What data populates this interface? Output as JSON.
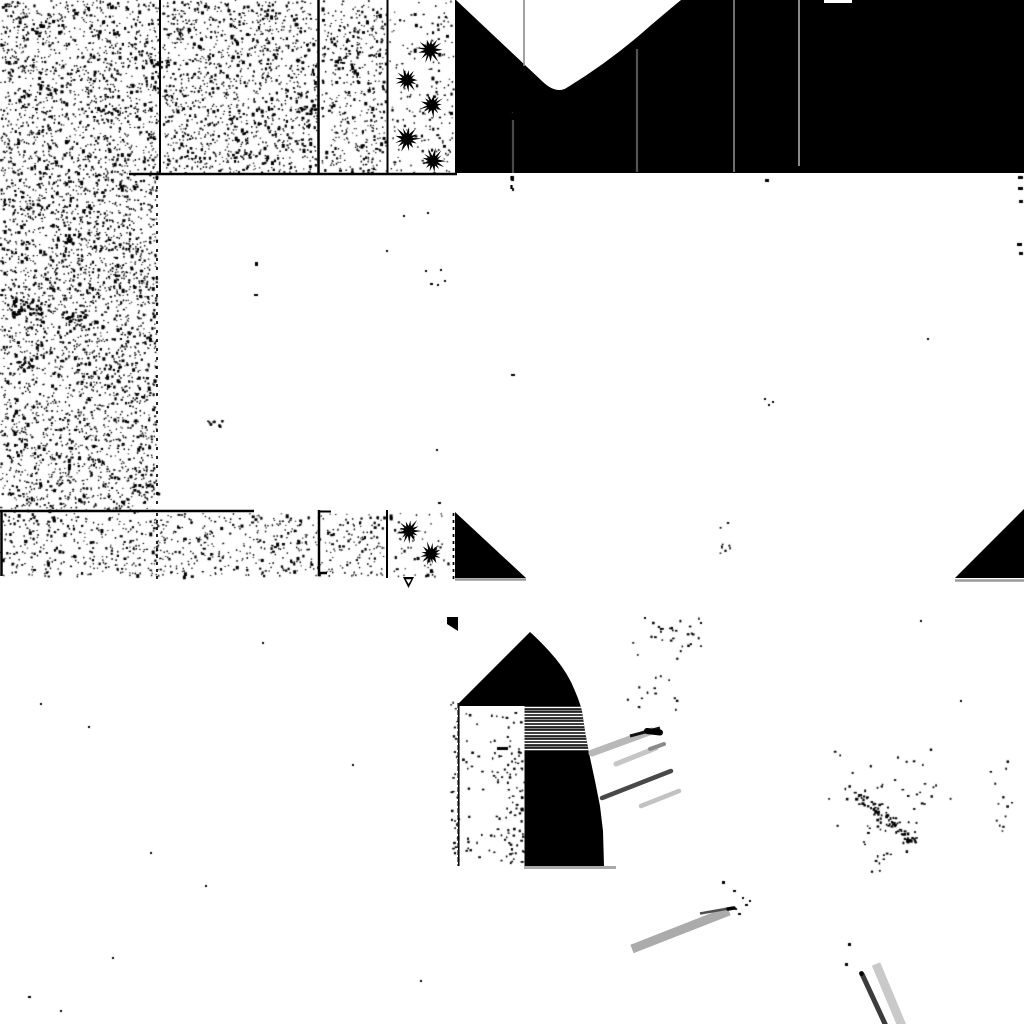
{
  "scene": {
    "width": 1024,
    "height": 1024,
    "background": "#ffffff",
    "ink": "#000000"
  },
  "palette": {
    "black": "#000000",
    "white": "#ffffff",
    "gray_dark": "#3c3c3c",
    "gray_mid": "#6f6f6f",
    "gray_light": "#b8b8b8",
    "gray_pale": "#c9c9c9",
    "underline_gray": "#9a9a9a"
  },
  "sky_region": {
    "x": 455,
    "y": 0,
    "w": 569,
    "h": 173,
    "color": "#000000"
  },
  "bite_path": "M456,0 L543,82 Q557,95 568,87 Q612,60 650,26 Q670,9 681,0 Z",
  "notch": {
    "x": 824,
    "y": 0,
    "w": 28,
    "h": 3
  },
  "pole_lines": [
    {
      "name": "pole-line-1",
      "x": 513,
      "y1": 112,
      "y2": 173,
      "color": "#4a4a4a",
      "w": 2.2
    },
    {
      "name": "pole-line-2",
      "x": 524,
      "y1": 0,
      "y2": 66,
      "color": "#8a8a8a",
      "w": 1.6
    },
    {
      "name": "pole-line-3",
      "x": 637,
      "y1": 49,
      "y2": 172,
      "color": "#555555",
      "w": 2.2
    },
    {
      "name": "pole-line-4",
      "x": 734,
      "y1": 0,
      "y2": 172,
      "color": "#6f6f6f",
      "w": 2.0
    },
    {
      "name": "pole-line-5",
      "x": 799,
      "y1": 0,
      "y2": 166,
      "color": "#8a8a8a",
      "w": 2.0
    }
  ],
  "grid_lines": [
    {
      "name": "tile-separator-1",
      "x1": 160,
      "y1": 0,
      "x2": 160,
      "y2": 173,
      "w": 2
    },
    {
      "name": "tile-separator-2",
      "x1": 318.5,
      "y1": 0,
      "x2": 318.5,
      "y2": 174,
      "w": 2.5
    },
    {
      "name": "tile-separator-3",
      "x1": 387.5,
      "y1": 0,
      "x2": 387.5,
      "y2": 173,
      "w": 2
    },
    {
      "name": "band-bottom-line",
      "x1": 129,
      "y1": 174,
      "x2": 457,
      "y2": 174,
      "w": 2.5
    },
    {
      "name": "band2-top-line",
      "x1": 0,
      "y1": 511,
      "x2": 254,
      "y2": 511,
      "w": 2.5
    },
    {
      "name": "band2-left-tick",
      "x1": 1.5,
      "y1": 511,
      "x2": 1.5,
      "y2": 576,
      "w": 2.5
    },
    {
      "name": "band2-separator-1",
      "x1": 319,
      "y1": 510,
      "x2": 319,
      "y2": 576,
      "w": 2.5
    },
    {
      "name": "band2-sep1-tick-a",
      "x1": 318,
      "y1": 511.5,
      "x2": 331,
      "y2": 511.5,
      "w": 2
    },
    {
      "name": "band2-sep1-tick-b",
      "x1": 318,
      "y1": 573,
      "x2": 327,
      "y2": 573,
      "w": 2.5
    },
    {
      "name": "band2-separator-2",
      "x1": 387,
      "y1": 510,
      "x2": 387,
      "y2": 578,
      "w": 2
    }
  ],
  "dashed_lines": [
    {
      "name": "dashed-edge-upper",
      "x1": 157,
      "y1": 177,
      "x2": 157,
      "y2": 509,
      "w": 1.7,
      "dash": "3 6"
    },
    {
      "name": "dashed-edge-band2",
      "x1": 157,
      "y1": 513,
      "x2": 157,
      "y2": 580,
      "w": 1.7,
      "dash": "3 4"
    },
    {
      "name": "dashed-edge-wedge",
      "x1": 453.5,
      "y1": 513,
      "x2": 453.5,
      "y2": 579,
      "w": 1.7,
      "dash": "3 4"
    },
    {
      "name": "dashed-sky-col",
      "x1": 511.5,
      "y1": 176,
      "x2": 511.5,
      "y2": 192,
      "w": 2.2,
      "dash": "4 5"
    }
  ],
  "trees_top": [
    {
      "cx": 430,
      "cy": 50,
      "r": 13,
      "seed": 21
    },
    {
      "cx": 407,
      "cy": 80,
      "r": 12,
      "seed": 22
    },
    {
      "cx": 432,
      "cy": 105,
      "r": 12,
      "seed": 23
    },
    {
      "cx": 407,
      "cy": 139,
      "r": 13,
      "seed": 24
    },
    {
      "cx": 433,
      "cy": 161,
      "r": 12,
      "seed": 25
    }
  ],
  "trees_band2": [
    {
      "cx": 409,
      "cy": 531,
      "r": 12,
      "seed": 26
    },
    {
      "cx": 431,
      "cy": 554,
      "r": 12,
      "seed": 27
    }
  ],
  "triangles": [
    {
      "name": "wedge-left",
      "points": "455,512 455,578 526,578"
    },
    {
      "name": "wedge-right",
      "points": "955,578 1024,578 1024,509"
    }
  ],
  "underlines": [
    {
      "name": "wedge-left-underline",
      "x1": 455,
      "y1": 579.5,
      "x2": 526,
      "y2": 579.5,
      "color": "#9a9a9a",
      "w": 2.5
    },
    {
      "name": "wedge-right-underline",
      "x1": 955,
      "y1": 580.5,
      "x2": 1024,
      "y2": 580.5,
      "color": "#9a9a9a",
      "w": 2.5
    },
    {
      "name": "dome-underline",
      "x1": 524,
      "y1": 867.5,
      "x2": 616,
      "y2": 867.5,
      "color": "#aaaaaa",
      "w": 3
    }
  ],
  "marker": {
    "outer": "403,577 414,577 408.5,588",
    "inner": "405.8,579.2 411.4,579.2 408.6,584"
  },
  "dome": {
    "wedge": "447,617 458,617 458,631 447,624",
    "path": "M530,632 Q538,639 549,651 Q563,666 571,682 Q579,699 582,711 L585,731 L589,753 L595,781 L600,806 L603,831 L604,866 L458,866 L458,704 Z",
    "strip": {
      "x": 459.5,
      "y": 706,
      "w": 65,
      "h": 160
    },
    "left_edge": {
      "x": 458.5,
      "y1": 703,
      "y2": 866,
      "w": 2.2,
      "dash": "5 2"
    },
    "stripe_x1": 500,
    "stripe_x2": 592,
    "stripes": [
      {
        "y": 707.5,
        "c": "#ffffff",
        "w": 1.6
      },
      {
        "y": 710.5,
        "c": "#8a8a8a",
        "w": 1.4
      },
      {
        "y": 713.5,
        "c": "#ffffff",
        "w": 1.6
      },
      {
        "y": 716.5,
        "c": "#ffffff",
        "w": 1.4
      },
      {
        "y": 719.5,
        "c": "#9a9a9a",
        "w": 1.4
      },
      {
        "y": 722.5,
        "c": "#ffffff",
        "w": 1.6
      },
      {
        "y": 725.5,
        "c": "#ffffff",
        "w": 1.4
      },
      {
        "y": 728.5,
        "c": "#8a8a8a",
        "w": 1.4
      },
      {
        "y": 731.5,
        "c": "#ffffff",
        "w": 1.6
      },
      {
        "y": 734.5,
        "c": "#ffffff",
        "w": 1.4
      },
      {
        "y": 737.5,
        "c": "#9a9a9a",
        "w": 1.4
      },
      {
        "y": 740.5,
        "c": "#ffffff",
        "w": 1.6
      },
      {
        "y": 743.5,
        "c": "#ffffff",
        "w": 1.4
      },
      {
        "y": 746.5,
        "c": "#8a8a8a",
        "w": 1.4
      },
      {
        "y": 749.5,
        "c": "#ffffff",
        "w": 1.5
      }
    ]
  },
  "streaks": [
    {
      "name": "motion-streak-1",
      "x1": 592,
      "y1": 753,
      "x2": 652,
      "y2": 731,
      "c": "#b8b8b8",
      "w": 7,
      "cap": "round"
    },
    {
      "name": "streak-1-dark-edge",
      "x1": 630,
      "y1": 736,
      "x2": 660,
      "y2": 728,
      "c": "#111111",
      "w": 3,
      "cap": "butt"
    },
    {
      "name": "streak-1-black-tip",
      "x1": 647,
      "y1": 731,
      "x2": 660,
      "y2": 732.5,
      "c": "#000000",
      "w": 6,
      "cap": "round"
    },
    {
      "name": "motion-streak-2",
      "x1": 616,
      "y1": 764,
      "x2": 656,
      "y2": 748,
      "c": "#c6c6c6",
      "w": 5,
      "cap": "round"
    },
    {
      "name": "streak-2-tip",
      "x1": 650,
      "y1": 749,
      "x2": 664,
      "y2": 744,
      "c": "#8a8a8a",
      "w": 4,
      "cap": "round"
    },
    {
      "name": "motion-streak-3",
      "x1": 602,
      "y1": 798,
      "x2": 671,
      "y2": 771,
      "c": "#484848",
      "w": 4.5,
      "cap": "round"
    },
    {
      "name": "motion-streak-4",
      "x1": 641,
      "y1": 806,
      "x2": 679,
      "y2": 791,
      "c": "#c2c2c2",
      "w": 4.5,
      "cap": "round"
    },
    {
      "name": "motion-streak-5",
      "x1": 632,
      "y1": 949,
      "x2": 729,
      "y2": 911,
      "c": "#ababab",
      "w": 9,
      "cap": "butt"
    },
    {
      "name": "streak-5-dark-edge",
      "x1": 700,
      "y1": 913.5,
      "x2": 734,
      "y2": 907.5,
      "c": "#4f4f4f",
      "w": 2.5,
      "cap": "butt"
    },
    {
      "name": "streak-5-black-tip",
      "x1": 728,
      "y1": 909,
      "x2": 734,
      "y2": 908,
      "c": "#000000",
      "w": 3.5,
      "cap": "round"
    },
    {
      "name": "motion-streak-6",
      "x1": 862,
      "y1": 974,
      "x2": 886,
      "y2": 1026,
      "c": "#3c3c3c",
      "w": 5,
      "cap": "butt"
    },
    {
      "name": "motion-streak-7",
      "x1": 876,
      "y1": 964,
      "x2": 902,
      "y2": 1026,
      "c": "#c9c9c9",
      "w": 9,
      "cap": "butt"
    }
  ],
  "svg_dots": [
    {
      "name": "streak-6-origin-dot",
      "cx": 861.5,
      "cy": 973.5,
      "r": 2.4
    }
  ],
  "noise_regions": [
    {
      "name": "terrain-texture-top-a",
      "x": 0,
      "y": 0,
      "w": 159,
      "h": 172,
      "d": 0.05,
      "seed": 1
    },
    {
      "name": "terrain-texture-top-b",
      "x": 162,
      "y": 0,
      "w": 155,
      "h": 172,
      "d": 0.048,
      "seed": 2
    },
    {
      "name": "terrain-texture-top-c",
      "x": 321,
      "y": 0,
      "w": 65,
      "h": 172,
      "d": 0.042,
      "seed": 3
    },
    {
      "name": "tree-tile-texture",
      "x": 389,
      "y": 0,
      "w": 64,
      "h": 172,
      "d": 0.016,
      "seed": 4
    },
    {
      "name": "terrain-texture-left",
      "x": 0,
      "y": 172,
      "w": 156,
      "h": 339,
      "d": 0.052,
      "seed": 5
    },
    {
      "name": "terrain-texture-band2",
      "x": 0,
      "y": 513,
      "w": 385,
      "h": 63,
      "d": 0.032,
      "seed": 6
    },
    {
      "name": "tree-tile-texture-2",
      "x": 389,
      "y": 513,
      "w": 63,
      "h": 63,
      "d": 0.014,
      "seed": 7
    }
  ],
  "clumps": [
    [
      12,
      298,
      36,
      16,
      48
    ],
    [
      55,
      236,
      18,
      8,
      16
    ],
    [
      98,
      108,
      22,
      7,
      14
    ],
    [
      296,
      104,
      26,
      9,
      18
    ],
    [
      130,
      484,
      28,
      9,
      18
    ],
    [
      206,
      420,
      20,
      6,
      10
    ],
    [
      326,
      56,
      16,
      6,
      10
    ],
    [
      16,
      358,
      16,
      12,
      16
    ],
    [
      60,
      310,
      26,
      10,
      20
    ],
    [
      150,
      60,
      18,
      7,
      10
    ],
    [
      230,
      150,
      22,
      7,
      12
    ]
  ],
  "clusters": [
    {
      "type": "ellipse",
      "name": "dust-cluster-a",
      "cx": 668,
      "cy": 634,
      "rx": 45,
      "ry": 28,
      "n": 22,
      "seed": 11
    },
    {
      "type": "ellipse",
      "name": "dust-cluster-b",
      "cx": 726,
      "cy": 540,
      "rx": 10,
      "ry": 24,
      "n": 9,
      "seed": 12
    },
    {
      "type": "diag",
      "name": "dust-trail",
      "x1": 855,
      "y1": 792,
      "x2": 915,
      "y2": 845,
      "spread": 8,
      "n": 75,
      "seed": 13
    },
    {
      "type": "ellipse",
      "name": "dust-halo",
      "cx": 885,
      "cy": 795,
      "rx": 66,
      "ry": 60,
      "n": 50,
      "seed": 14
    },
    {
      "type": "ellipse",
      "name": "dust-tail",
      "cx": 880,
      "cy": 862,
      "rx": 12,
      "ry": 14,
      "n": 10,
      "seed": 15
    },
    {
      "type": "ellipse",
      "name": "dust-right-edge",
      "cx": 1002,
      "cy": 795,
      "rx": 20,
      "ry": 58,
      "n": 13,
      "seed": 16
    },
    {
      "type": "ellipse",
      "name": "dust-near-dome",
      "cx": 660,
      "cy": 690,
      "rx": 38,
      "ry": 44,
      "n": 14,
      "seed": 17
    },
    {
      "type": "ellipse",
      "name": "dust-apex-right",
      "cx": 692,
      "cy": 640,
      "rx": 16,
      "ry": 24,
      "n": 7,
      "seed": 18
    },
    {
      "type": "rect",
      "name": "dome-strip-speckle-a",
      "x": 462,
      "y": 712,
      "w": 60,
      "h": 150,
      "n": 70,
      "seed": 19
    },
    {
      "type": "rect",
      "name": "dome-strip-speckle-b",
      "x": 505,
      "y": 745,
      "w": 19,
      "h": 118,
      "n": 55,
      "seed": 20
    },
    {
      "type": "rect",
      "name": "dome-strip-speckle-c",
      "x": 450,
      "y": 700,
      "w": 10,
      "h": 164,
      "n": 25,
      "seed": 21
    }
  ],
  "specks": [
    [
      255,
      262,
      3,
      4
    ],
    [
      254,
      294,
      4,
      2
    ],
    [
      386,
      250,
      2,
      2
    ],
    [
      403,
      215,
      2,
      2
    ],
    [
      427,
      212,
      2,
      2
    ],
    [
      425,
      270,
      2,
      2
    ],
    [
      437,
      284,
      2,
      2
    ],
    [
      444,
      280,
      2,
      2
    ],
    [
      511,
      176,
      3,
      5
    ],
    [
      512,
      188,
      2,
      3
    ],
    [
      511,
      374,
      4,
      2
    ],
    [
      440,
      269,
      2,
      2
    ],
    [
      430,
      283,
      3,
      2
    ],
    [
      436,
      449,
      2,
      2
    ],
    [
      438,
      502,
      3,
      2
    ],
    [
      765,
      179,
      4,
      3
    ],
    [
      764,
      398,
      2,
      2
    ],
    [
      772,
      401,
      2,
      2
    ],
    [
      768,
      404,
      2,
      2
    ],
    [
      927,
      338,
      2,
      2
    ],
    [
      1018,
      176,
      5,
      3
    ],
    [
      1018,
      187,
      5,
      3
    ],
    [
      1019,
      200,
      4,
      3
    ],
    [
      1017,
      243,
      5,
      3
    ],
    [
      1019,
      252,
      4,
      3
    ],
    [
      497,
      747,
      11,
      3
    ],
    [
      722,
      881,
      3,
      3
    ],
    [
      733,
      890,
      3,
      2
    ],
    [
      742,
      897,
      2,
      2
    ],
    [
      745,
      904,
      3,
      2
    ],
    [
      735,
      908,
      2,
      2
    ],
    [
      738,
      913,
      3,
      2
    ],
    [
      749,
      900,
      2,
      2
    ],
    [
      848,
      943,
      3,
      3
    ],
    [
      845,
      963,
      3,
      3
    ],
    [
      88,
      726,
      2,
      2
    ],
    [
      40,
      703,
      2,
      2
    ],
    [
      150,
      852,
      2,
      2
    ],
    [
      112,
      957,
      2,
      2
    ],
    [
      28,
      996,
      3,
      2
    ],
    [
      262,
      642,
      2,
      2
    ],
    [
      205,
      885,
      2,
      2
    ],
    [
      352,
      764,
      2,
      2
    ],
    [
      420,
      980,
      2,
      2
    ],
    [
      60,
      1010,
      2,
      2
    ],
    [
      920,
      620,
      2,
      2
    ],
    [
      960,
      700,
      2,
      2
    ],
    [
      644,
      617,
      2,
      2
    ],
    [
      700,
      622,
      2,
      2
    ]
  ]
}
